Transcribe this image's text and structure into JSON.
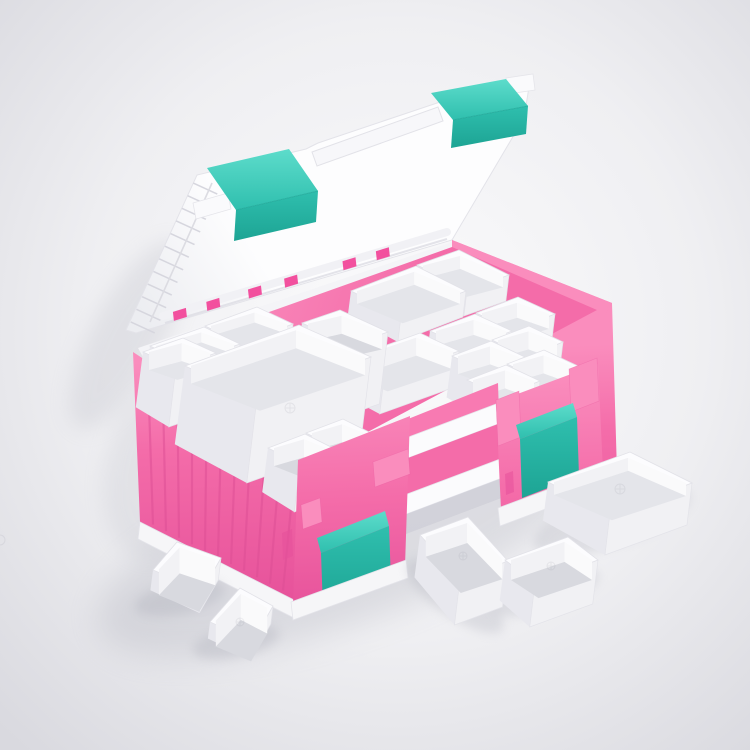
{
  "meta": {
    "type": "product-photo-render",
    "description": "Open pink plastic organizer case with mint-green latches; white hinged lid opened upward, interior filled with removable white storage trays of assorted sizes, and five loose white trays placed on the studio floor around the case",
    "background": "light gray studio gradient vignette"
  },
  "colors": {
    "bg-center": "#fbfbfc",
    "bg-mid": "#efeff2",
    "bg-edge": "#d9d9df",
    "pink": "#f46ca9",
    "pink-light": "#fa8dbd",
    "pink-floor": "#f66fae",
    "pink-deep": "#e6519a",
    "pink-rib": "#dd4e95",
    "pink-clip": "#f2509e",
    "teal": "#2fbfae",
    "teal-light": "#5ddccb",
    "teal-dark": "#1da494",
    "lid-white": "#fdfdfe",
    "lid-shade": "#ecedf1",
    "tray-white": "#fcfcfe",
    "tray-interior": "#e4e5ea",
    "tray-interior-deep": "#d8d9df",
    "tray-inner-wall": "#f2f2f5",
    "tray-skirt": "#f1f1f4",
    "tray-skirt-dark": "#e8e8ee",
    "base-white": "#f6f6f8",
    "shadow": "#a9aab6",
    "outline": "#e3e3e9"
  },
  "scene": {
    "case": {
      "body_color": "pink",
      "latch_color": "mint",
      "lid_state": "open",
      "lid_latches": 2,
      "front_latches": 2,
      "lid_clip_count": 6,
      "left_wall_rib_count": 11
    },
    "trays": {
      "inside_count": 16,
      "outside_count": 5
    }
  }
}
